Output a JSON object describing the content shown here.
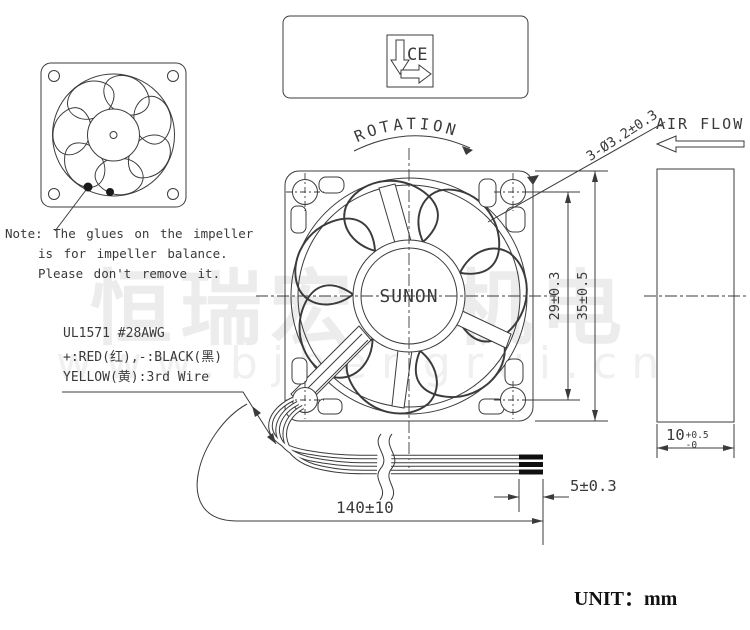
{
  "page": {
    "background": "#ffffff"
  },
  "colors": {
    "line": "#3b3b3b",
    "text": "#3a3a3a",
    "wire_tip": "#101010",
    "watermark": "#ececec"
  },
  "note": {
    "line1": "Note: The glues on the impeller",
    "line2": "is for impeller balance.",
    "line3": "Please don't remove it."
  },
  "wire_spec": {
    "line1": "UL1571  #28AWG",
    "line2": "+:RED(红),-:BLACK(黑)",
    "line3": "YELLOW(黄):3rd Wire"
  },
  "labels": {
    "rotation": "ROTATION",
    "air_flow": "AIR FLOW",
    "brand": "SUNON",
    "ce": "CE",
    "unit": "UNIT：mm"
  },
  "dimensions": {
    "mounting_holes": "3-Ø3.2±0.3",
    "hole_pitch": "29±0.3",
    "frame_size": "35±0.5",
    "thickness": {
      "value": "10",
      "upper_tol": "+0.5",
      "lower_tol": "-0"
    },
    "strip_length": "5±0.3",
    "lead_length": "140±10"
  },
  "watermark": {
    "cjk": "恒瑞宏晟机电",
    "latin": "www.bjhengrui.cn"
  }
}
